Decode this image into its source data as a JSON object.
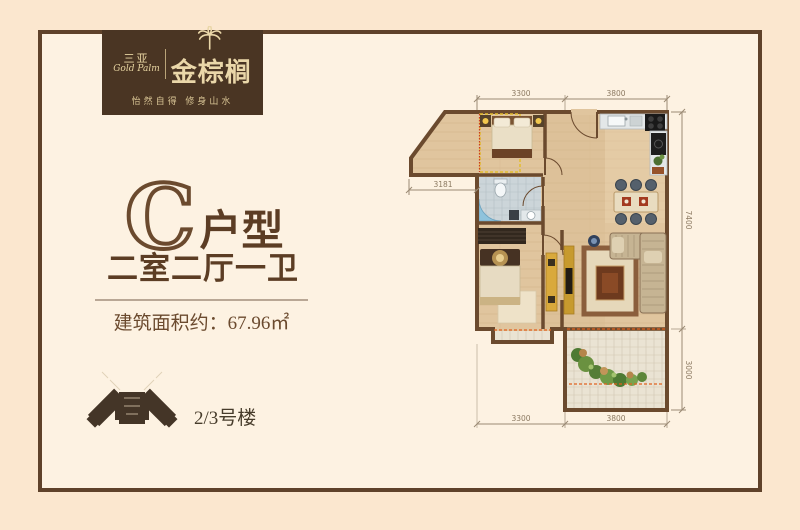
{
  "brand": {
    "name_cn_small": "三亚",
    "name_en": "Gold Palm",
    "name_cn_large": "金棕榈",
    "tagline": "怡然自得 修身山水"
  },
  "unit_info": {
    "unit_letter": "C",
    "unit_type_suffix": "户型",
    "rooms_desc": "二室二厅一卫",
    "area_label": "建筑面积约：",
    "area_value": "67.96㎡",
    "building_label": "2/3号楼"
  },
  "floorplan": {
    "dims": {
      "top_left": "3300",
      "top_right": "3800",
      "left": "3181",
      "right_upper": "7400",
      "right_lower": "3000",
      "bottom_left": "3300",
      "bottom_right": "3800"
    },
    "colors": {
      "wall": "#6b4a2e",
      "floor": "#e0c59e",
      "tile": "#ccd5d9",
      "balcony_tile": "#eae3d3",
      "window_dash": "#e0621f",
      "bay_dash": "#e3bd2e"
    }
  },
  "icons": {
    "palm": "palm-tree-icon",
    "building": "building-footprint-icon"
  }
}
